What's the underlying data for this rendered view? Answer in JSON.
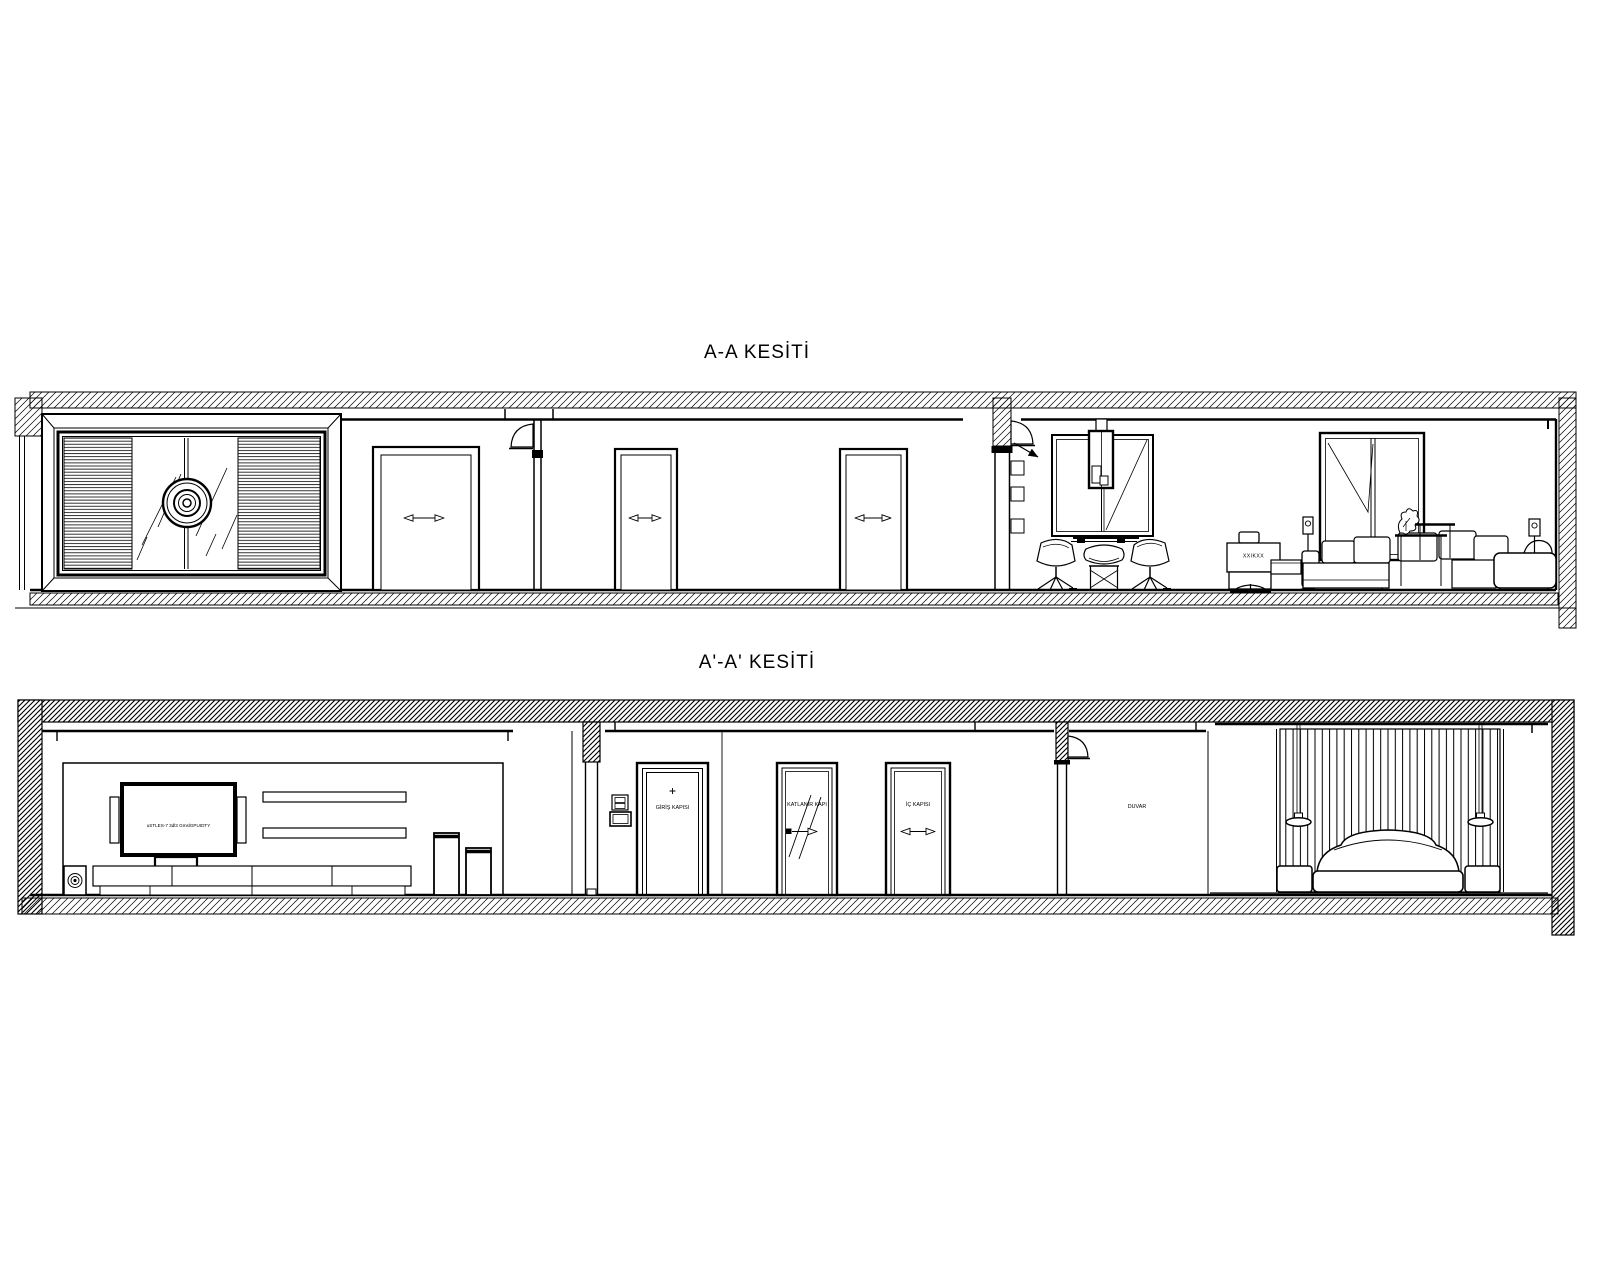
{
  "page": {
    "background": "#ffffff",
    "line_color": "#000000"
  },
  "sections": {
    "top": {
      "title": "A-A KESİTİ",
      "chair_monogram": "XXIKXX"
    },
    "bottom": {
      "title": "A'-A' KESİTİ",
      "tv_screen_text": "uSTLES-7 3dl3 GmslGPUIDTY",
      "entry_door_label": "GİRİŞ KAPISI",
      "folding_door_label": "KATLANIR KAPI",
      "interior_door_label": "İÇ KAPISI",
      "wall_label": "DUVAR"
    }
  }
}
